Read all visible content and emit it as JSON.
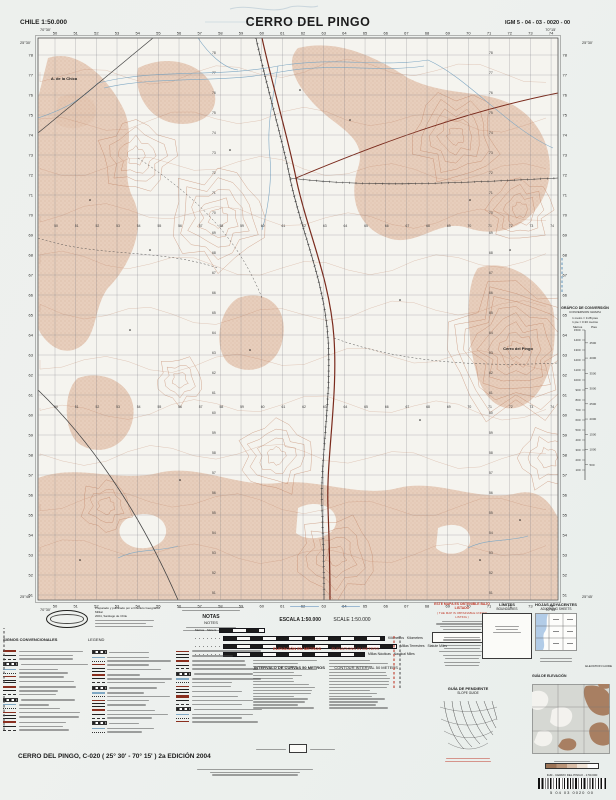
{
  "header": {
    "left": "CHILE  1:50.000",
    "title": "CERRO DEL PINGO",
    "right": "IGM 5 - 04 - 03 - 0020 - 00"
  },
  "map": {
    "corners": {
      "tl_lon": "70°30'",
      "tl_lat": "25°30'",
      "tr_lon": "70°15'",
      "tr_lat": "25°30'",
      "bl_lon": "70°30'",
      "bl_lat": "25°45'",
      "br_lon": "70°15'",
      "br_lat": "25°45'"
    },
    "grid_columns": [
      "50",
      "51",
      "52",
      "53",
      "54",
      "55",
      "56",
      "57",
      "58",
      "59",
      "60",
      "61",
      "62",
      "63",
      "64",
      "65",
      "66",
      "67",
      "68",
      "69",
      "70",
      "71",
      "72",
      "73",
      "74"
    ],
    "grid_rows": [
      "78",
      "77",
      "76",
      "75",
      "74",
      "73",
      "72",
      "71",
      "70",
      "69",
      "68",
      "67",
      "66",
      "65",
      "64",
      "63",
      "62",
      "61",
      "60",
      "59",
      "58",
      "57",
      "56",
      "55",
      "54",
      "53",
      "52",
      "51"
    ],
    "labels": [
      {
        "text": "A. de la Chica",
        "x": 64,
        "y": 80
      },
      {
        "text": "Cerro del Pingo",
        "x": 518,
        "y": 350
      }
    ]
  },
  "credits": {
    "line1": "Preparado y publicado por el Instituto Geográfico Militar",
    "line2": "2004, Santiago de Chile"
  },
  "notes": {
    "es": "NOTAS",
    "en": "NOTES"
  },
  "scale": {
    "es": "ESCALA 1:50.000",
    "en": "SCALE 1:50.000",
    "metros": "Metros",
    "meters": "Meters",
    "bars": [
      {
        "es": "Kilómetros",
        "en": "Kilometers"
      },
      {
        "es": "Millas Terrestres",
        "en": "Statute Miles"
      },
      {
        "es": "Millas Náuticas",
        "en": "Nautical Miles"
      }
    ]
  },
  "elevation_note": {
    "es": "ELEVACIÓN EN METROS",
    "en": "ELEVATIONS IN METERS",
    "interval_es": "INTERVALO DE CURVAS 50 METROS",
    "interval_en": "CONTOUR INTERVAL 50 METERS"
  },
  "legend": {
    "es": "SIGNOS CONVENCIONALES",
    "en": "LEGEND"
  },
  "red_note": {
    "es": "ESTE MAPA ES OBTENIBLE BAJO LISTADO",
    "en": "( THE MAP IS OBTAINABLE UNDER LISTING )"
  },
  "limits": {
    "es": "LÍMITES",
    "en": "BOUNDARIES"
  },
  "adjoining": {
    "es": "HOJAS ADYACENTES",
    "en": "ADJOINING SHEETS"
  },
  "slope": {
    "es": "GUÍA DE PENDIENTE",
    "en": "SLOPE GUIDE"
  },
  "elev_guide": {
    "es": "GUÍA DE ELEVACIÓN",
    "en": "ELEVATION GUIDE"
  },
  "conversion": {
    "es": "GRÁFICO DE CONVERSIÓN",
    "en": "CONVERSION GRAPH",
    "sub1": "1 metro = 3.28 pies",
    "sub2": "1 pie = 0.30 metros",
    "col_es": "Metros",
    "col_en": "Pies",
    "meters": [
      1500,
      1400,
      1300,
      1200,
      1100,
      1000,
      900,
      800,
      700,
      600,
      500,
      400,
      300,
      200,
      100
    ]
  },
  "publisher": {
    "imprint": "IGM - CERRO DEL PINGO - 1:50.000",
    "barcode_digits": "5     04     03     0020     00"
  },
  "footer": {
    "title": "CERRO DEL PINGO, C-020 ( 25° 30' - 70° 15' )  2a EDICIÓN 2004"
  },
  "colors": {
    "contour": "#c08263",
    "relief": "#e4c7b3",
    "water": "#7fa8c4",
    "road": "#7a2a1c",
    "red_note": "#c03a2a",
    "adjoining_water": "#aac7e4"
  }
}
